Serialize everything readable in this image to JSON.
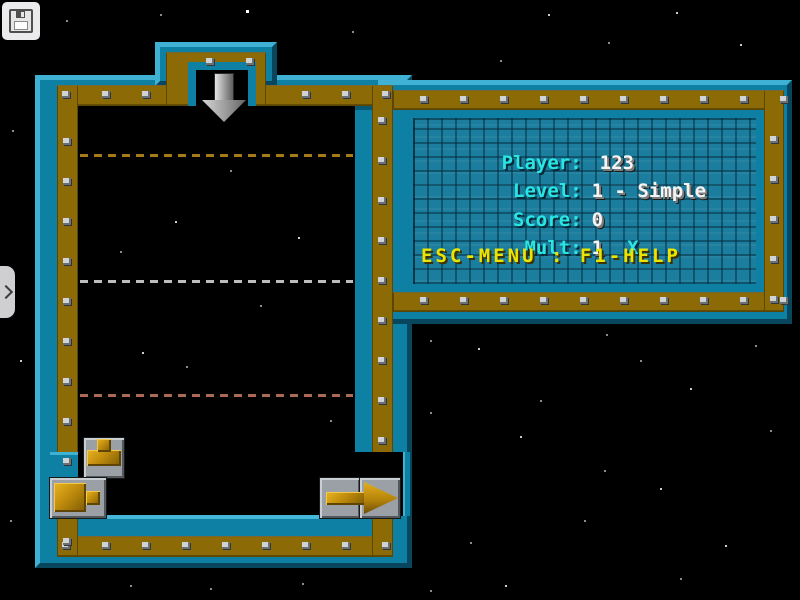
{
  "window": {
    "toolbar": {
      "save_button": {
        "icon": "floppy-disk-icon"
      }
    },
    "side_tab": {
      "chevron": "›"
    }
  },
  "hud": {
    "rows": [
      {
        "label": "Player:",
        "value": "123"
      },
      {
        "label": "Level:",
        "value": "1 - Simple"
      },
      {
        "label": "Score:",
        "value": "0"
      },
      {
        "label": "Mult:",
        "value": "1",
        "suffix": "X"
      }
    ],
    "help": "ESC-MENU : F1-HELP",
    "colors": {
      "label": "#29e5e3",
      "value": "#f4f4f4",
      "help": "#eae400",
      "panel_bg": "#1b7e9e"
    }
  },
  "frame": {
    "colors": {
      "teal": "#0d80a4",
      "teal_light": "#3fb1d3",
      "teal_dark": "#07465c",
      "gold": "#8c6a06",
      "gold_dark": "#5c4604",
      "rivet": "#cfd3d6"
    }
  },
  "playfield": {
    "drop_arrow": "down",
    "guide_lines": [
      {
        "y": 155,
        "color": "#a57a1a"
      },
      {
        "y": 281,
        "color": "#bdbdbd"
      },
      {
        "y": 395,
        "color": "#aa6a55"
      }
    ],
    "pieces": [
      {
        "name": "pipe-tee-up"
      },
      {
        "name": "faucet-right"
      },
      {
        "name": "exit-arrow-right"
      }
    ]
  },
  "background": {
    "stars": [
      [
        246,
        10,
        2
      ],
      [
        548,
        14,
        1
      ],
      [
        676,
        12,
        1
      ],
      [
        352,
        31,
        0
      ],
      [
        740,
        44,
        1
      ],
      [
        608,
        42,
        0
      ],
      [
        500,
        60,
        0
      ],
      [
        66,
        20,
        0
      ],
      [
        160,
        14,
        0
      ],
      [
        12,
        130,
        0
      ],
      [
        20,
        360,
        1
      ],
      [
        10,
        520,
        0
      ],
      [
        175,
        221,
        1
      ],
      [
        298,
        237,
        1
      ],
      [
        120,
        251,
        0
      ],
      [
        142,
        352,
        1
      ],
      [
        186,
        366,
        0
      ],
      [
        118,
        461,
        1
      ],
      [
        94,
        443,
        0
      ],
      [
        260,
        305,
        0
      ],
      [
        230,
        170,
        0
      ],
      [
        330,
        420,
        0
      ],
      [
        430,
        340,
        0
      ],
      [
        478,
        348,
        1
      ],
      [
        640,
        360,
        0
      ],
      [
        690,
        388,
        1
      ],
      [
        755,
        345,
        0
      ],
      [
        606,
        334,
        0
      ],
      [
        540,
        400,
        0
      ],
      [
        430,
        412,
        0
      ],
      [
        520,
        436,
        1
      ],
      [
        604,
        470,
        0
      ],
      [
        770,
        430,
        0
      ],
      [
        660,
        488,
        1
      ],
      [
        584,
        520,
        0
      ],
      [
        470,
        542,
        0
      ],
      [
        725,
        545,
        1
      ],
      [
        505,
        585,
        1
      ],
      [
        430,
        590,
        0
      ],
      [
        302,
        583,
        0
      ],
      [
        130,
        585,
        0
      ],
      [
        680,
        578,
        0
      ],
      [
        210,
        588,
        0
      ]
    ]
  }
}
